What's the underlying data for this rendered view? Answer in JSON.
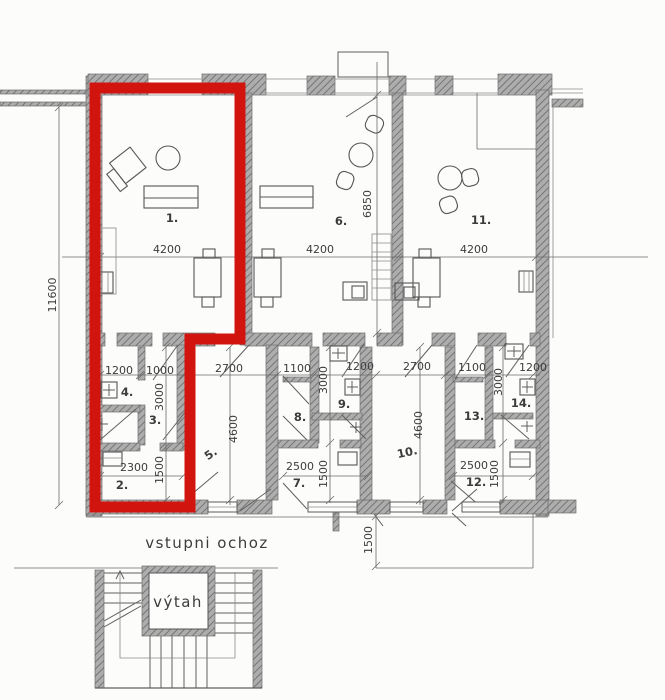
{
  "colors": {
    "highlight": "#d2140f",
    "wall_line": "#6e6e6e",
    "line": "#5f5f5f",
    "label": "#3c3c3c",
    "paper": "#fcfcfa"
  },
  "rooms": [
    "1.",
    "2.",
    "3.",
    "4.",
    "5.",
    "6.",
    "7.",
    "8.",
    "9.",
    "10.",
    "11.",
    "12.",
    "13.",
    "14."
  ],
  "dims_h": [
    "4200",
    "4200",
    "4200",
    "1200",
    "1000",
    "2700",
    "1100",
    "1200",
    "2700",
    "1100",
    "1200",
    "2300",
    "2500",
    "2500"
  ],
  "dims_v": [
    "11600",
    "6850",
    "3000",
    "1500",
    "4600",
    "3000",
    "1500",
    "4600",
    "3000",
    "1500",
    "1500"
  ],
  "texts": {
    "walkway": "vstupni ochoz",
    "elevator": "výtah"
  }
}
